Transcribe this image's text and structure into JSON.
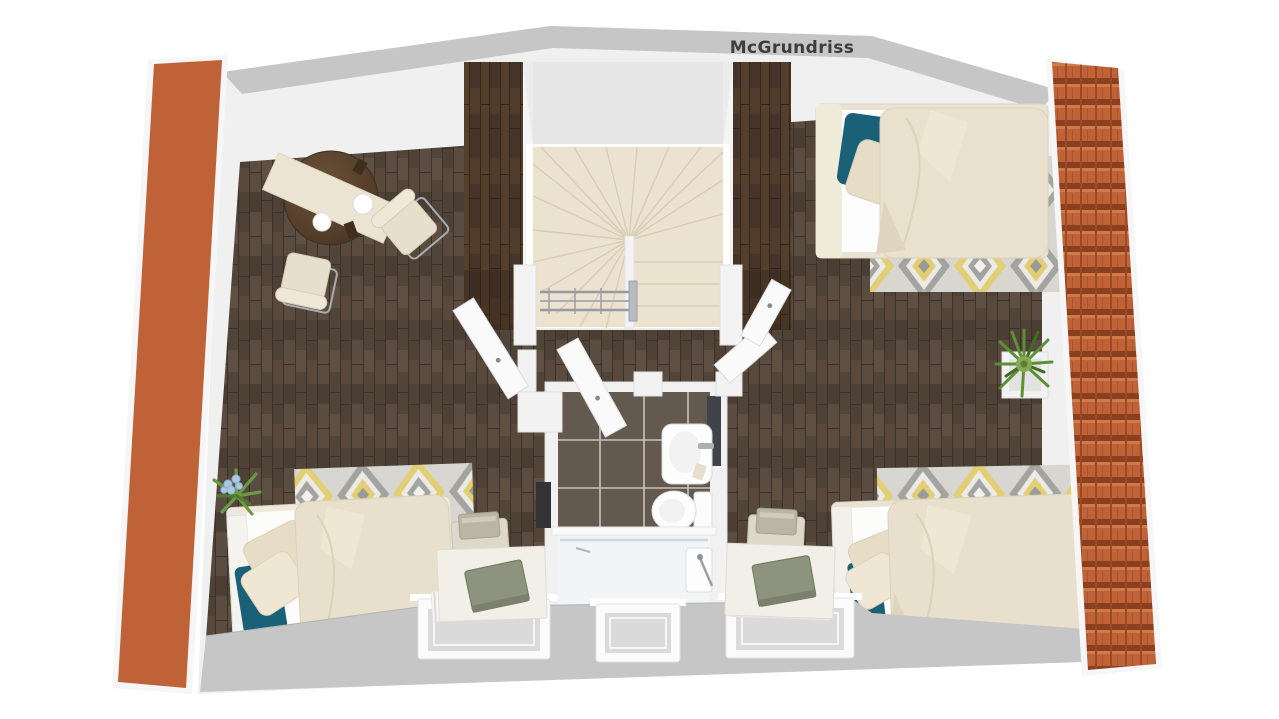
{
  "watermark": "McGrundriss",
  "palette": {
    "wall_gray": "#c6c6c6",
    "wall_white": "#f0f0f0",
    "floor_brown": "#55483d",
    "stair_wood": "#4a3829",
    "stair_tread_cream": "#ece2d0",
    "roof_tile_orange": "#c06238",
    "roof_tile_shadow": "#8a3f1f",
    "accent_teal": "#1a6076",
    "textile_cream": "#e8e0cc",
    "rug_base": "#d8d6d1",
    "rug_yellow": "#e2cf74",
    "rug_gray": "#a3a39f",
    "bathroom_tile": "#64594e",
    "bathroom_grout": "#c9c3bc",
    "chrome": "#9aa0a5",
    "plant_green": "#5d8f35",
    "flower_blue": "#a9c9e2",
    "laptop_green": "#8e937f",
    "text_dark": "#3d3d3d"
  }
}
